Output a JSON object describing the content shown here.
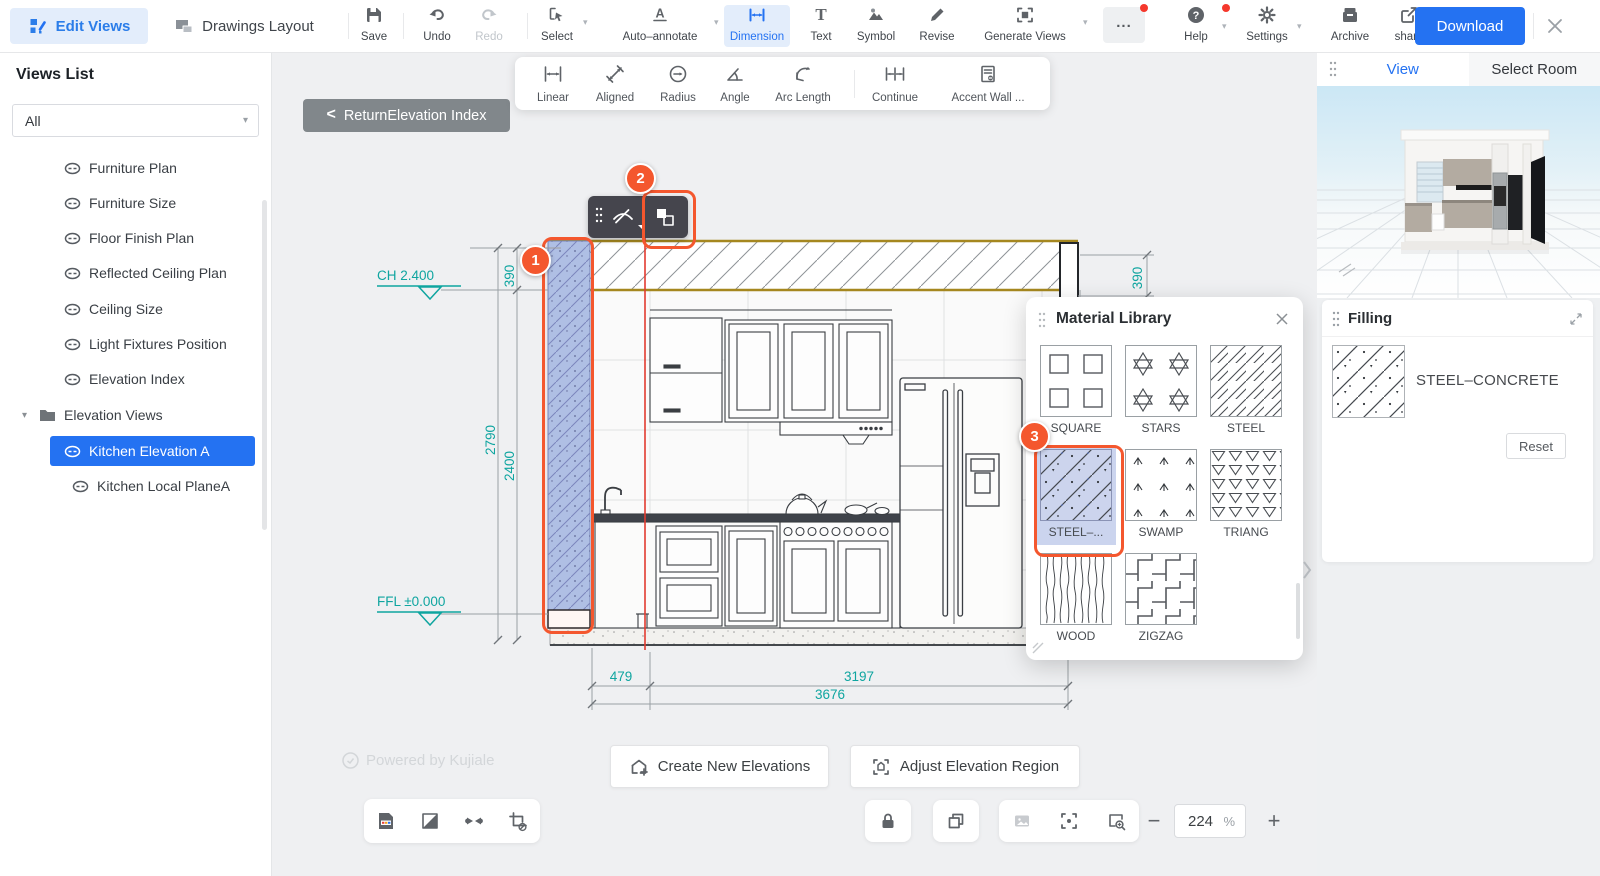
{
  "colors": {
    "accent_blue": "#2472f2",
    "marker_orange": "#f4572e",
    "dimension_teal": "#0fa5a0",
    "red_guide_line": "#e23b30",
    "selected_wall_fill": "#abc5ef",
    "ceiling_band_border": "#a5871f",
    "selected_tile_bg": "#cbd4ee",
    "download_button": "#2472f2"
  },
  "icons": [
    "edit-views-icon",
    "drawings-layout-icon",
    "save-icon",
    "undo-icon",
    "redo-icon",
    "select-icon",
    "auto-annotate-icon",
    "dimension-icon",
    "text-icon",
    "symbol-icon",
    "revise-icon",
    "generate-views-icon",
    "more-icon",
    "help-icon",
    "settings-icon",
    "archive-icon",
    "share-icon",
    "close-icon",
    "linear-icon",
    "aligned-icon",
    "radius-icon",
    "angle-icon",
    "arc-length-icon",
    "continue-icon",
    "accent-wall-icon",
    "link-icon",
    "folder-icon",
    "eye-off-icon",
    "material-swap-icon",
    "grip-icon",
    "home-plus-icon",
    "adjust-region-icon",
    "lock-icon",
    "duplicate-icon",
    "image-icon",
    "focus-icon",
    "zoom-area-icon",
    "minus-icon",
    "plus-icon",
    "doc-image-icon",
    "half-square-icon",
    "bowtie-icon",
    "crop-slash-icon",
    "collapse-arrows-icon",
    "chevron-right-icon",
    "check-circle-icon"
  ],
  "topbar": {
    "edit_views_label": "Edit Views",
    "drawings_layout_label": "Drawings Layout",
    "save_label": "Save",
    "undo_label": "Undo",
    "redo_label": "Redo",
    "select_label": "Select",
    "auto_annotate_label": "Auto–annotate",
    "dimension_label": "Dimension",
    "text_label": "Text",
    "symbol_label": "Symbol",
    "revise_label": "Revise",
    "generate_views_label": "Generate Views",
    "more_label": "...",
    "help_label": "Help",
    "settings_label": "Settings",
    "archive_label": "Archive",
    "share_label": "share",
    "download_label": "Download"
  },
  "dim_toolbar": {
    "items": [
      {
        "label": "Linear"
      },
      {
        "label": "Aligned"
      },
      {
        "label": "Radius"
      },
      {
        "label": "Angle"
      },
      {
        "label": "Arc Length"
      },
      {
        "label": "Continue"
      },
      {
        "label": "Accent Wall ..."
      }
    ]
  },
  "sidebar": {
    "title": "Views List",
    "filter_value": "All",
    "items": [
      {
        "label": "Furniture Plan"
      },
      {
        "label": "Furniture Size"
      },
      {
        "label": "Floor Finish Plan"
      },
      {
        "label": "Reflected Ceiling Plan"
      },
      {
        "label": "Ceiling Size"
      },
      {
        "label": "Light Fixtures Position"
      },
      {
        "label": "Elevation Index"
      }
    ],
    "folder_label": "Elevation Views",
    "selected_label": "Kitchen Elevation A",
    "sub_label": "Kitchen Local PlaneA"
  },
  "canvas": {
    "back_chevron": "<",
    "back_label": "ReturnElevation Index",
    "levels": {
      "ceiling": "CH 2.400",
      "floor": "FFL ±0.000"
    },
    "dims": {
      "band_left": "390",
      "band_right": "390",
      "total_height": "2790",
      "wall_height": "2400",
      "seg_left": "479",
      "seg_right": "3197",
      "total_width": "3676"
    },
    "markers": {
      "m1": "1",
      "m2": "2",
      "m3": "3"
    },
    "watermark": "Powered by Kujiale",
    "create_label": "Create New Elevations",
    "adjust_label": "Adjust Elevation Region",
    "zoom_value": "224",
    "zoom_unit": "%"
  },
  "material_library": {
    "title": "Material Library",
    "materials": [
      {
        "name": "SQUARE"
      },
      {
        "name": "STARS"
      },
      {
        "name": "STEEL"
      },
      {
        "name": "STEEL–..."
      },
      {
        "name": "SWAMP"
      },
      {
        "name": "TRIANG"
      },
      {
        "name": "WOOD"
      },
      {
        "name": "ZIGZAG"
      }
    ]
  },
  "right_panel": {
    "tab_view": "View",
    "tab_select_room": "Select Room",
    "filling": {
      "title": "Filling",
      "material_name": "STEEL–CONCRETE",
      "reset_label": "Reset"
    }
  }
}
